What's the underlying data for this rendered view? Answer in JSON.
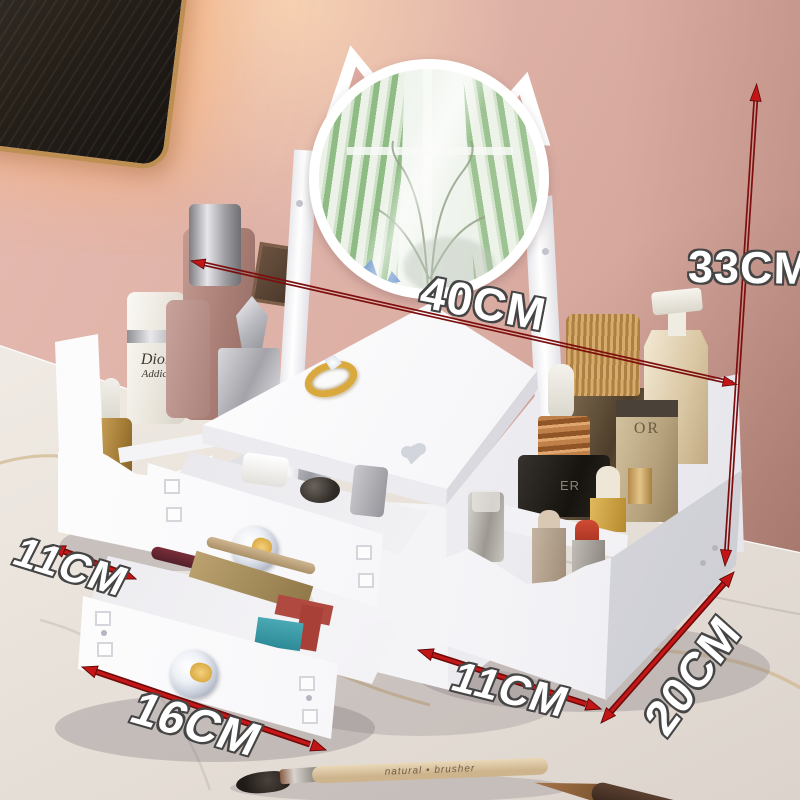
{
  "annotations": {
    "width_top": "40CM",
    "height_right": "33CM",
    "depth_left_drawer": "11CM",
    "width_bottom_drawer": "16CM",
    "width_right_tray": "11CM",
    "depth_right_tray": "20CM"
  },
  "products": {
    "white_bottle_brand": "Dior",
    "white_bottle_line": "Addict",
    "beige_bottle_text": "OR",
    "black_jar_text": "ER",
    "brush_handle_text": "natural • brusher"
  },
  "palette": {
    "annotation_red": "#b01010",
    "wall_pink": "#ddafa5",
    "marble_light": "#f2eee8",
    "organizer_white": "#ffffff",
    "mirror_curtain_green": "#8fbb85",
    "gold_accent": "#d9a93e"
  }
}
